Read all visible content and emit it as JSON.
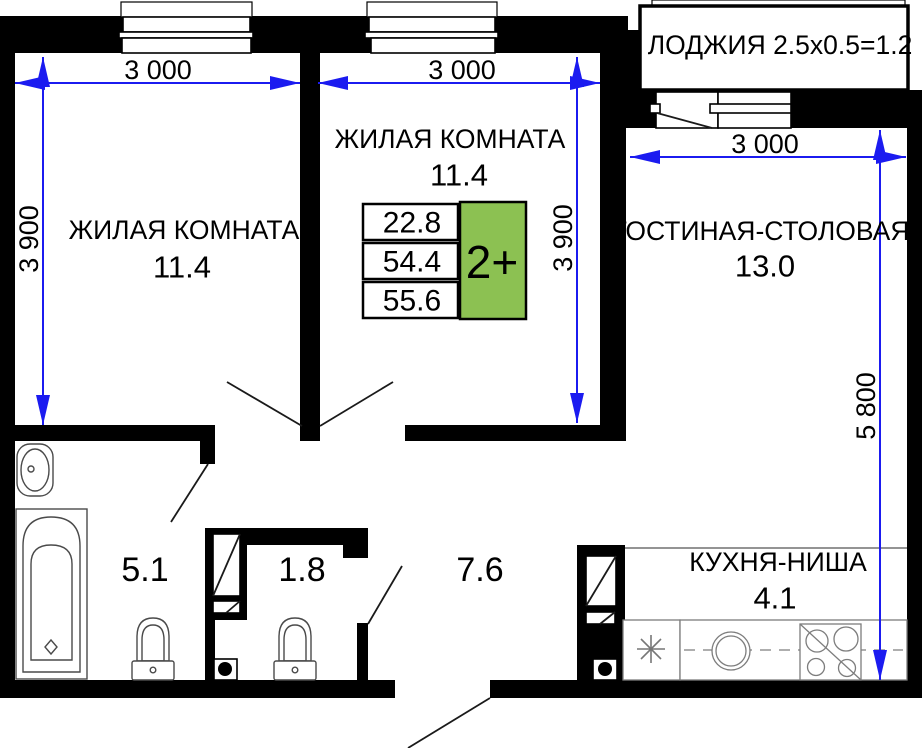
{
  "plan": {
    "rooms": {
      "bedroom_left": {
        "name": "ЖИЛАЯ КОМНАТА",
        "area": "11.4"
      },
      "bedroom_middle": {
        "name": "ЖИЛАЯ КОМНАТА",
        "area": "11.4"
      },
      "living_dining": {
        "name": "ГОСТИНАЯ-СТОЛОВАЯ",
        "area": "13.0"
      },
      "kitchen_niche": {
        "name": "КУХНЯ-НИША",
        "area": "4.1"
      },
      "loggia": {
        "name": "ЛОДЖИЯ 2.5х0.5=1.2"
      },
      "bathroom": {
        "area": "5.1"
      },
      "wc": {
        "area": "1.8"
      },
      "hallway": {
        "area": "7.6"
      }
    },
    "dimensions": {
      "bedroom_left": {
        "width": "3 000",
        "height": "3 900"
      },
      "bedroom_middle": {
        "width": "3 000",
        "height": "3 900"
      },
      "living_dining": {
        "width": "3 000",
        "height": "5 800"
      }
    },
    "info_table": {
      "rows": [
        "22.8",
        "54.4",
        "55.6"
      ],
      "badge": "2+"
    },
    "colors": {
      "wall": "#000000",
      "dimension_blue": "#1b1bf0",
      "badge_green": "#8cc152"
    }
  }
}
